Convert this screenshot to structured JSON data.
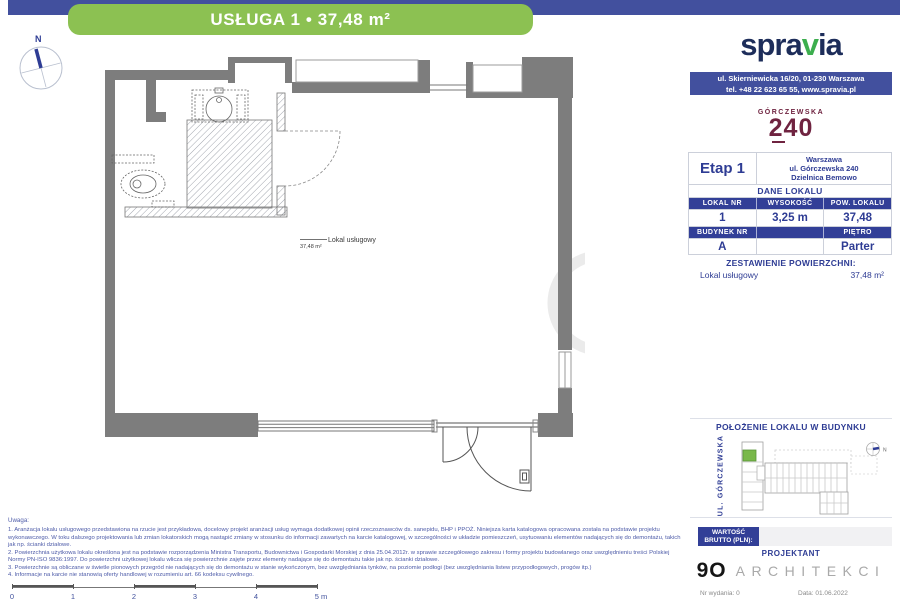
{
  "header": {
    "title": "USŁUGA 1 • 37,48 m²"
  },
  "brand": {
    "name_part1": "spra",
    "name_accent": "v",
    "name_part2": "ia",
    "address_line1": "ul. Skierniewicka 16/20, 01-230 Warszawa",
    "address_line2": "tel. +48 22 623 65 55, www.spravia.pl"
  },
  "project_logo": {
    "name": "GÓRCZEWSKA",
    "number": "240"
  },
  "info": {
    "stage": "Etap 1",
    "city": "Warszawa",
    "street": "ul. Górczewska 240",
    "district": "Dzielnica Bemowo",
    "section_title": "DANE LOKALU",
    "headers": {
      "unit_no": "LOKAL NR",
      "height": "WYSOKOŚĆ",
      "area": "POW. LOKALU",
      "building_no": "BUDYNEK NR",
      "floor": "PIĘTRO"
    },
    "values": {
      "unit_no": "1",
      "height": "3,25 m",
      "area": "37,48",
      "building_no": "A",
      "floor": "Parter"
    }
  },
  "areas": {
    "title": "ZESTAWIENIE POWIERZCHNI:",
    "rows": [
      {
        "name": "Lokal usługowy",
        "value": "37,48 m²"
      }
    ]
  },
  "location": {
    "title": "POŁOŻENIE LOKALU W BUDYNKU",
    "street_label": "UL. GÓRCZEWSKA",
    "compass_label": "N"
  },
  "price": {
    "label_line1": "WARTOŚĆ",
    "label_line2": "BRUTTO (PLN):",
    "value": ""
  },
  "designer": {
    "title": "PROJEKTANT",
    "logo_number": "9O",
    "logo_text": "ARCHITEKCI"
  },
  "footer": {
    "issue": "Nr wydania: 0",
    "date": "Data: 01.06.2022"
  },
  "plan": {
    "room_label": "Lokal usługowy",
    "room_area": "37,48 m²",
    "compass_label": "N"
  },
  "notes": {
    "label": "Uwaga:",
    "items": [
      "1. Aranżacja lokalu usługowego przedstawiona na rzucie jest przykładowa, docelowy projekt aranżacji usług wymaga dodatkowej opinii rzeczoznawców ds. sanepidu, BHP i PPOŻ. Niniejsza karta katalogowa opracowana została na podstawie projektu wykonawczego. W toku dalszego projektowania lub zmian lokatorskich mogą nastąpić zmiany w stosunku do informacji zawartych na karcie katalogowej, w szczególności w układzie pomieszczeń, usytuowaniu elementów nadających się do demontażu, takich jak np. ścianki działowe.",
      "2. Powierzchnia użytkowa lokalu określona jest na podstawie rozporządzenia Ministra Transportu, Budownictwa i Gospodarki Morskiej z dnia 25.04.2012r. w sprawie szczegółowego zakresu i formy projektu budowlanego oraz uwzględnieniu treści Polskiej Normy PN-ISO 9836:1997. Do powierzchni użytkowej lokalu wlicza się powierzchnie zajęte przez elementy nadające się do demontażu takie jak np. ścianki działowe.",
      "3. Powierzchnie są obliczane w świetle pionowych przegród nie nadających się do demontażu w stanie wykończonym, bez uwzględniania tynków, na poziomie podłogi (bez uwzględniania listew przypodłogowych, progów itp.)",
      "4. Informacje na karcie nie stanowią oferty handlowej w rozumieniu art. 66 kodeksu cywilnego."
    ]
  },
  "scale_bar": {
    "labels": [
      "0",
      "1",
      "2",
      "3",
      "4",
      "5 m"
    ]
  },
  "colors": {
    "top_bar": "#42509e",
    "header_green": "#8cc152",
    "navy": "#2e3c94",
    "table_header": "#323f97",
    "brand_navy": "#1d2d5a",
    "brand_green": "#3cae4e",
    "logo_maroon": "#6f2340",
    "unit_highlight": "#79b84a",
    "wall_gray": "#7d7d7d"
  }
}
